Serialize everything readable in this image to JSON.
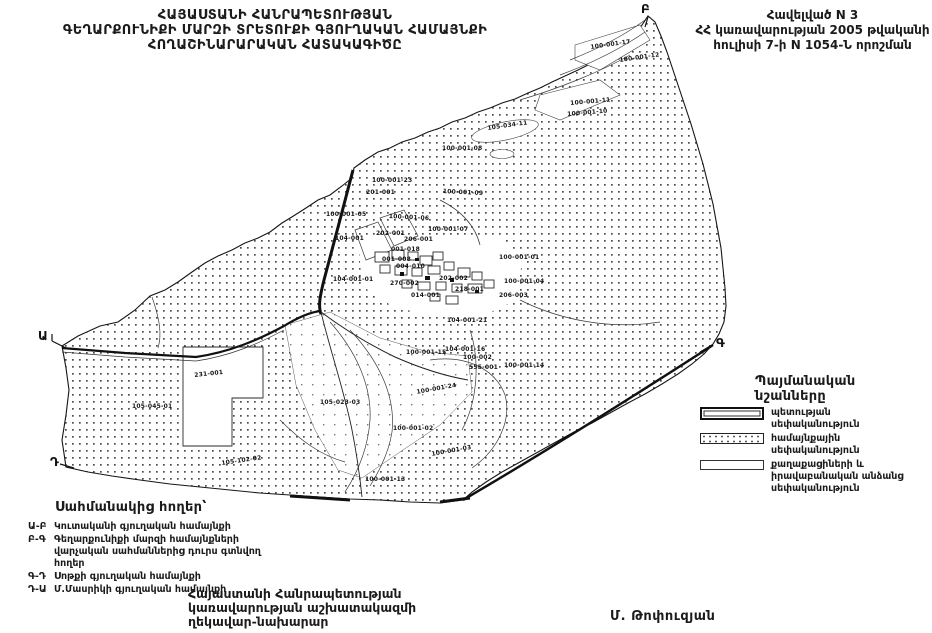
{
  "page": {
    "background": "#ffffff",
    "ink": "#1b1b1b"
  },
  "header": {
    "title_lines": [
      "ՀԱՅԱՍՏԱՆԻ ՀԱՆՐԱՊԵՏՈՒԹՅԱՆ",
      "ԳԵՂԱՐՔՈՒՆԻՔԻ ՄԱՐԶԻ ՏՐԵՏՈՒՔԻ ԳՅՈՒՂԱԿԱՆ  ՀԱՄԱՅՆՔԻ",
      "ՀՈՂԱՇԻՆԱՐԱՐԱԿԱՆ ՀԱՏԱԿԱԳԻԾԸ"
    ],
    "annex_lines": [
      "Հավելված N 3",
      "ՀՀ կառավարության 2005 թվականի",
      "հուլիսի 7-ի N 1054-Ն որոշման"
    ]
  },
  "legend": {
    "title": "Պայմանական նշանները",
    "items": [
      {
        "key": "state",
        "label": "պետության սեփականություն"
      },
      {
        "key": "community",
        "label": "համայնքային սեփականություն"
      },
      {
        "key": "private",
        "label": "քաղաքացիների և իրավաբանական անձանց սեփականություն"
      }
    ]
  },
  "border_lands": {
    "title": "Սահմանակից հողեր՝",
    "items": [
      {
        "code": "Ա-Բ",
        "label": "Կուտականի գյուղական համայնքի"
      },
      {
        "code": "Բ-Գ",
        "label": "Գեղարքունիքի մարզի համայնքների վարչական սահմաններից դուրս գտնվող հողեր"
      },
      {
        "code": "Գ-Դ",
        "label": "Սոթքի գյուղական համայնքի"
      },
      {
        "code": "Դ-Ա",
        "label": "Մ.Մասրիկի գյուղական համայնքի"
      }
    ]
  },
  "footer": {
    "issuer_lines": [
      "Հայաստանի Հանրապետության",
      "կառավարության աշխատակազմի",
      "ղեկավար-նախարար"
    ],
    "signature": "Մ. Թոփուզյան"
  },
  "map": {
    "corner_letters": [
      {
        "t": "Ա",
        "x": 38,
        "y": 329
      },
      {
        "t": "Բ",
        "x": 641,
        "y": 2
      },
      {
        "t": "Գ",
        "x": 716,
        "y": 336
      },
      {
        "t": "Դ",
        "x": 50,
        "y": 455
      }
    ],
    "parcel_labels": [
      {
        "t": "100-001-17",
        "x": 590,
        "y": 44,
        "r": -8
      },
      {
        "t": "100-001-12",
        "x": 619,
        "y": 57,
        "r": -8
      },
      {
        "t": "100-001-11",
        "x": 570,
        "y": 100,
        "r": -5
      },
      {
        "t": "100-001-10",
        "x": 567,
        "y": 111,
        "r": -5
      },
      {
        "t": "105-034-11",
        "x": 487,
        "y": 125,
        "r": -8
      },
      {
        "t": "100-001-08",
        "x": 442,
        "y": 145,
        "r": 0
      },
      {
        "t": "100-001-23",
        "x": 372,
        "y": 177,
        "r": 0
      },
      {
        "t": "201-001",
        "x": 366,
        "y": 189,
        "r": 0
      },
      {
        "t": "100-001-09",
        "x": 443,
        "y": 188,
        "r": 3
      },
      {
        "t": "100-001-05",
        "x": 326,
        "y": 211,
        "r": 0
      },
      {
        "t": "100-001-06",
        "x": 389,
        "y": 213,
        "r": 3
      },
      {
        "t": "100-001-07",
        "x": 428,
        "y": 226,
        "r": 0
      },
      {
        "t": "104-001",
        "x": 335,
        "y": 235,
        "r": 0
      },
      {
        "t": "202-001",
        "x": 376,
        "y": 230,
        "r": 0
      },
      {
        "t": "206-001",
        "x": 404,
        "y": 236,
        "r": 0
      },
      {
        "t": "001-018",
        "x": 391,
        "y": 246,
        "r": 0
      },
      {
        "t": "001-008",
        "x": 382,
        "y": 256,
        "r": 0
      },
      {
        "t": "004-010",
        "x": 396,
        "y": 263,
        "r": 0
      },
      {
        "t": "104-001-01",
        "x": 333,
        "y": 276,
        "r": 0
      },
      {
        "t": "270-002",
        "x": 390,
        "y": 280,
        "r": 0
      },
      {
        "t": "202-002",
        "x": 439,
        "y": 275,
        "r": 0
      },
      {
        "t": "100-001-01",
        "x": 499,
        "y": 254,
        "r": 0
      },
      {
        "t": "100-001-04",
        "x": 504,
        "y": 278,
        "r": 0
      },
      {
        "t": "218-001",
        "x": 455,
        "y": 286,
        "r": 0
      },
      {
        "t": "014-001",
        "x": 411,
        "y": 292,
        "r": 0
      },
      {
        "t": "206-003",
        "x": 499,
        "y": 292,
        "r": 0
      },
      {
        "t": "104-001-21",
        "x": 447,
        "y": 317,
        "r": 0
      },
      {
        "t": "104-001-16",
        "x": 445,
        "y": 346,
        "r": 0
      },
      {
        "t": "100-001-15",
        "x": 406,
        "y": 349,
        "r": 0
      },
      {
        "t": "100-002",
        "x": 463,
        "y": 354,
        "r": 0
      },
      {
        "t": "555-001",
        "x": 469,
        "y": 364,
        "r": 0
      },
      {
        "t": "100-001-14",
        "x": 504,
        "y": 362,
        "r": 0
      },
      {
        "t": "231-001",
        "x": 194,
        "y": 372,
        "r": -6
      },
      {
        "t": "105-045-01",
        "x": 132,
        "y": 403,
        "r": 0
      },
      {
        "t": "105-023-03",
        "x": 320,
        "y": 399,
        "r": 0
      },
      {
        "t": "100-001-24",
        "x": 416,
        "y": 389,
        "r": -10
      },
      {
        "t": "100-001-02",
        "x": 393,
        "y": 425,
        "r": 0
      },
      {
        "t": "105-102-02",
        "x": 221,
        "y": 460,
        "r": -8
      },
      {
        "t": "100-001-03",
        "x": 431,
        "y": 451,
        "r": -10
      },
      {
        "t": "100-001-13",
        "x": 365,
        "y": 476,
        "r": 0
      }
    ]
  }
}
